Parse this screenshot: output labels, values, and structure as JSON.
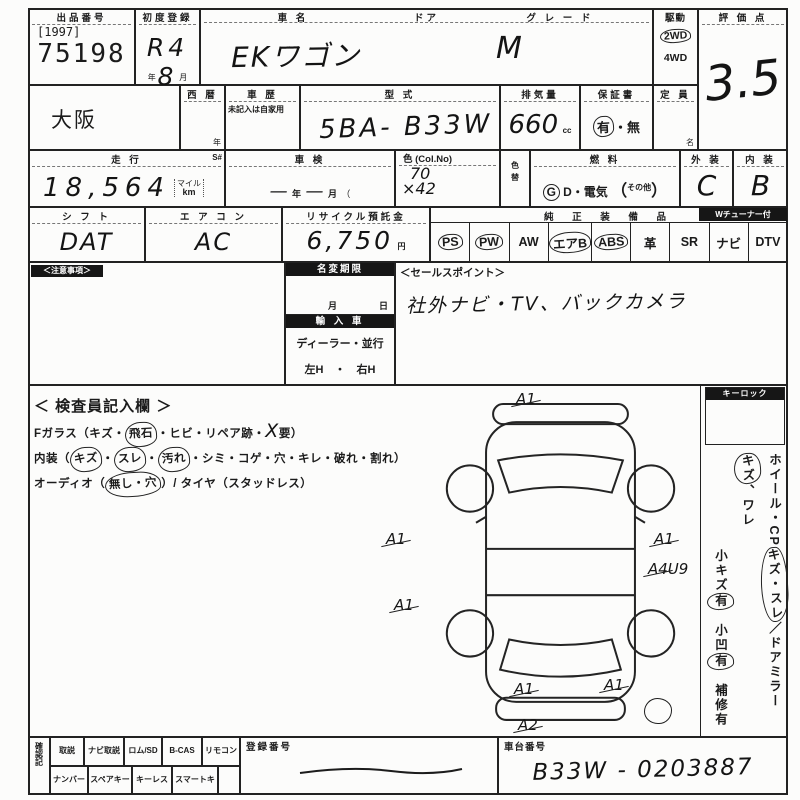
{
  "colors": {
    "ink": "#1b1b1b",
    "paper": "#fcfcfb"
  },
  "top": {
    "lot_label": "出品番号",
    "lot_bracket": "[1997]",
    "lot_number": "75198",
    "first_reg_label": "初度登録",
    "first_reg": "R4 8",
    "year_unit": "年",
    "month_unit": "月",
    "name_label": "車  名",
    "door_label": "ドア",
    "grade_label": "グ レ ー ド",
    "car_name": "EKワゴン",
    "grade": "M",
    "drive_label": "駆動",
    "drive_top": "2WD",
    "drive_bottom": "4WD",
    "score_label": "評 価 点",
    "score": "3.5"
  },
  "row2": {
    "region": "大阪",
    "seireki_label": "西  暦",
    "seireki_unit": "年",
    "history_label": "車  歴",
    "history_note": "未記入は自家用",
    "model_label": "型  式",
    "model": "5BA- B33W",
    "disp_label": "排気量",
    "disp": "660",
    "disp_unit": "cc",
    "warranty_label": "保証書",
    "warranty_yes": "有",
    "warranty_sep": "・",
    "warranty_no": "無",
    "capacity_label": "定 員",
    "capacity_unit": "名"
  },
  "row3": {
    "mileage_label": "走  行",
    "s_label": "S#",
    "mileage": "18,564",
    "mile_unit_top": "マイル",
    "mile_unit": "km",
    "shaken_label": "車  検",
    "dash1": "—",
    "shaken_year": "年",
    "dash2": "—",
    "shaken_month": "月",
    "paren": "（",
    "color_label": "色 (Col.No)",
    "color_line1": "70",
    "color_line2": "×42",
    "colorchg_label": "色替",
    "fuel_label": "燃  料",
    "fuel_g": "G",
    "fuel_rest": "D・電気",
    "fuel_paren_l": "（",
    "fuel_other": "その他",
    "fuel_paren_r": "）",
    "ext_label": "外 装",
    "ext": "C",
    "int_label": "内 装",
    "int": "B"
  },
  "row4": {
    "shift_label": "シ フ ト",
    "shift": "DAT",
    "ac_label": "エ ア コ ン",
    "ac": "AC",
    "recycle_label": "リサイクル預託金",
    "recycle": "6,750",
    "yen": "円",
    "equip_label": "純 正 装 備 品",
    "tuner_note": "Wチューナー付",
    "items": [
      {
        "label": "PS",
        "circled": true
      },
      {
        "label": "PW",
        "circled": true
      },
      {
        "label": "AW",
        "circled": false
      },
      {
        "label": "エアB",
        "circled": true
      },
      {
        "label": "ABS",
        "circled": true
      },
      {
        "label": "革",
        "circled": false
      },
      {
        "label": "SR",
        "circled": false
      },
      {
        "label": "ナビ",
        "circled": false
      },
      {
        "label": "DTV",
        "circled": false
      }
    ]
  },
  "middle": {
    "notes_label": "＜注意事項＞",
    "namechange_label": "名変期限",
    "month": "月",
    "day": "日",
    "import_label": "輸 入 車",
    "import_type": "ディーラー・並行",
    "import_handle": "左H　・　右H",
    "sales_label": "＜セールスポイント＞",
    "sales_text": "社外ナビ・TV、バックカメラ"
  },
  "inspector": {
    "title": "＜ 検査員記入欄 ＞",
    "l1": [
      "Fガラス（キズ・",
      "飛石",
      "・ヒビ・リペア跡・",
      "X",
      "要）"
    ],
    "l2": [
      "内装（",
      "キズ",
      "・",
      "スレ",
      "・",
      "汚れ",
      "・シミ・コゲ・穴・キレ・破れ・割れ）"
    ],
    "l3": [
      "オーディオ（",
      "無し・穴",
      "）/ タイヤ（スタッドレス）"
    ]
  },
  "right_col": {
    "keylock_label": "キーロック",
    "lineA": [
      "ホイール・CP",
      "キズ・スレ",
      "／ドアミラー",
      "キズ",
      "、ワレ"
    ],
    "lineB": [
      "小キズ",
      "有",
      "　小凹",
      "有",
      "　補修有"
    ]
  },
  "diagram": {
    "marks": [
      "A1",
      "A1",
      "A1",
      "A1",
      "A4U9",
      "A1",
      "A1",
      "A2"
    ]
  },
  "bottom": {
    "side_label": "確認記",
    "row1": [
      "取説",
      "ナビ取説",
      "ロム/SD",
      "B-CAS",
      "リモコン"
    ],
    "row2": [
      "ナンバー",
      "スペアキー",
      "キーレス",
      "スマートキー"
    ],
    "regno_label": "登録番号",
    "chassis_label": "車台番号",
    "chassis": "B33W - 0203887"
  }
}
